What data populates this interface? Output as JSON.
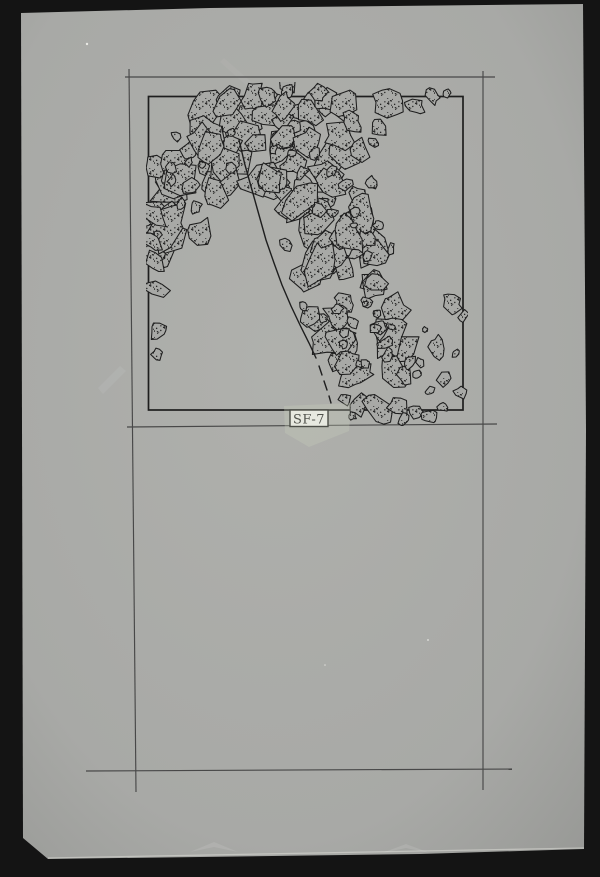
{
  "scan": {
    "colors": {
      "background": "#141414",
      "paper": "#a8a9a6",
      "paper_light": "#afb0ac",
      "paper_dark": "#999a97",
      "ink": "#1e1e1e",
      "pencil": "#484848",
      "stipple": "#232323",
      "label_paper": "#f4f4ef",
      "label_ink": "#1c1c1c",
      "tape": "rgba(203,209,188,0.30)"
    }
  },
  "label": {
    "text": "SF-7"
  },
  "drawing": {
    "seed": 7,
    "frame_lines": [
      [
        125,
        77,
        495,
        77
      ],
      [
        127,
        427,
        497,
        424
      ],
      [
        86,
        771,
        512,
        769
      ],
      [
        129,
        69,
        136,
        792
      ],
      [
        483,
        71,
        483,
        790
      ]
    ],
    "plan_box": [
      148.5,
      96.5,
      314.5,
      313.5
    ],
    "curve_line": [
      [
        239,
        140
      ],
      [
        245,
        165
      ],
      [
        252,
        190
      ],
      [
        259,
        215
      ],
      [
        266,
        240
      ],
      [
        274,
        263
      ],
      [
        282,
        285
      ],
      [
        291,
        306
      ],
      [
        300,
        325
      ],
      [
        309,
        343
      ],
      [
        316,
        358
      ]
    ],
    "curve_dashes": [
      [
        [
          319,
          366
        ],
        [
          322,
          375
        ]
      ],
      [
        [
          324,
          381
        ],
        [
          327,
          390
        ]
      ],
      [
        [
          329,
          396
        ],
        [
          331,
          403
        ]
      ]
    ],
    "bands": [
      {
        "path": [
          [
            160,
            250
          ],
          [
            168,
            196
          ],
          [
            200,
            154
          ],
          [
            248,
            124
          ],
          [
            300,
            110
          ]
        ],
        "half_width": 36,
        "count": 44,
        "rmin": 8,
        "rmax": 18
      },
      {
        "path": [
          [
            160,
            250
          ],
          [
            168,
            196
          ],
          [
            200,
            154
          ],
          [
            248,
            124
          ],
          [
            300,
            110
          ]
        ],
        "half_width": 34,
        "count": 16,
        "rmin": 3,
        "rmax": 6.5
      },
      {
        "path": [
          [
            262,
            118
          ],
          [
            306,
            106
          ],
          [
            350,
            101
          ]
        ],
        "half_width": 24,
        "count": 14,
        "rmin": 7,
        "rmax": 13
      },
      {
        "path": [
          [
            298,
            146
          ],
          [
            311,
            192
          ],
          [
            324,
            242
          ],
          [
            341,
            287
          ],
          [
            359,
            327
          ],
          [
            371,
            362
          ],
          [
            385,
            397
          ]
        ],
        "half_width": 45,
        "count": 62,
        "rmin": 8,
        "rmax": 18
      },
      {
        "path": [
          [
            298,
            146
          ],
          [
            311,
            192
          ],
          [
            324,
            242
          ],
          [
            341,
            287
          ],
          [
            359,
            327
          ],
          [
            371,
            362
          ],
          [
            385,
            397
          ]
        ],
        "half_width": 43,
        "count": 28,
        "rmin": 3,
        "rmax": 7
      }
    ],
    "scatter": [
      [
        388,
        100,
        17
      ],
      [
        414,
        106,
        8
      ],
      [
        433,
        96,
        6
      ],
      [
        447,
        93,
        4
      ],
      [
        352,
        122,
        8
      ],
      [
        378,
        128,
        8
      ],
      [
        374,
        143,
        5
      ],
      [
        358,
        150,
        12
      ],
      [
        372,
        183,
        7
      ],
      [
        355,
        212,
        6
      ],
      [
        378,
        226,
        5
      ],
      [
        391,
        249,
        4
      ],
      [
        368,
        256,
        5
      ],
      [
        154,
        215,
        10
      ],
      [
        152,
        240,
        9
      ],
      [
        155,
        262,
        9
      ],
      [
        156,
        288,
        9
      ],
      [
        158,
        330,
        10
      ],
      [
        157,
        355,
        6
      ],
      [
        452,
        302,
        9
      ],
      [
        463,
        316,
        5
      ],
      [
        437,
        347,
        8
      ],
      [
        456,
        353,
        4
      ],
      [
        444,
        380,
        7
      ],
      [
        461,
        393,
        6
      ],
      [
        430,
        391,
        4
      ],
      [
        345,
        399,
        6
      ],
      [
        360,
        404,
        9
      ],
      [
        378,
        408,
        11
      ],
      [
        398,
        407,
        10
      ],
      [
        416,
        412,
        8
      ],
      [
        429,
        416,
        6
      ],
      [
        404,
        419,
        5
      ],
      [
        352,
        416,
        4
      ],
      [
        443,
        407,
        5
      ],
      [
        420,
        363,
        4
      ],
      [
        425,
        330,
        3
      ]
    ]
  }
}
